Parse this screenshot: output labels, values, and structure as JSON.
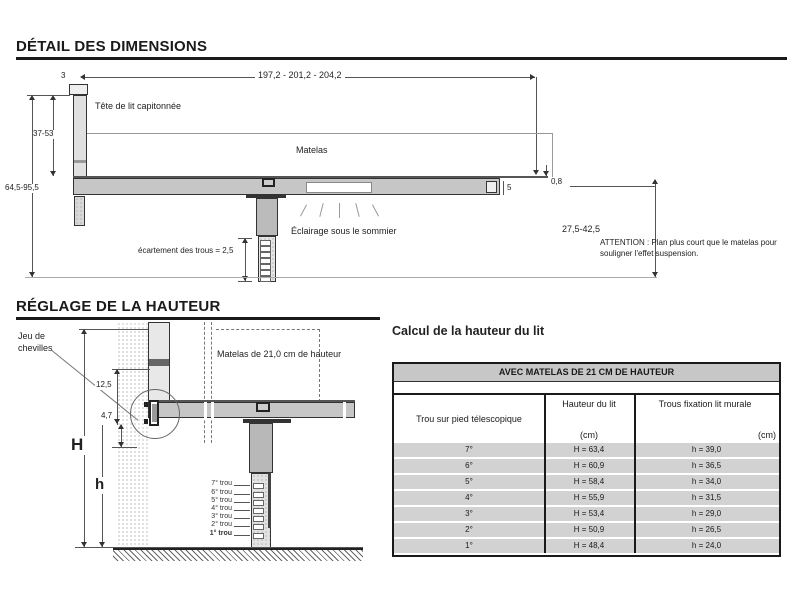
{
  "dim": {
    "title": "DÉTAIL DES DIMENSIONS",
    "length": "197,2 - 201,2 - 204,2",
    "cap_thickness": "3",
    "headboard": "Tête de lit capitonnée",
    "mattress": "Matelas",
    "headboard_height": "37-53",
    "overall_height": "64,5-95,5",
    "end_gap": "5",
    "plan_thickness": "0,8",
    "under_height": "27,5-42,5",
    "lighting": "Éclairage sous le sommier",
    "hole_spacing": "écartement des trous = 2,5",
    "attention": "ATTENTION : Plan plus court que le matelas pour souligner l'effet suspension."
  },
  "reglage": {
    "title": "RÉGLAGE DE LA HAUTEUR",
    "dowel_line1": "Jeu de",
    "dowel_line2": "chevilles",
    "mattress": "Matelas de 21,0 cm de hauteur",
    "dim_125": "12,5",
    "dim_47": "4,7",
    "big_h": "H",
    "small_h": "h",
    "holes": [
      "7° trou",
      "6° trou",
      "5° trou",
      "4° trou",
      "3° trou",
      "2° trou",
      "1° trou"
    ]
  },
  "table": {
    "title": "Calcul de la hauteur du lit",
    "band": "AVEC MATELAS DE 21 CM DE HAUTEUR",
    "col1": "Trou sur pied télescopique",
    "col2": "Hauteur du lit",
    "col2_unit": "(cm)",
    "col3": "Trous fixation lit murale",
    "col3_unit": "(cm)",
    "rows": [
      [
        "7°",
        "H = 63,4",
        "h = 39,0"
      ],
      [
        "6°",
        "H = 60,9",
        "h = 36,5"
      ],
      [
        "5°",
        "H = 58,4",
        "h = 34,0"
      ],
      [
        "4°",
        "H = 55,9",
        "h = 31,5"
      ],
      [
        "3°",
        "H = 53,4",
        "h = 29,0"
      ],
      [
        "2°",
        "H = 50,9",
        "h = 26,5"
      ],
      [
        "1°",
        "H = 48,4",
        "h = 24,0"
      ]
    ]
  },
  "colors": {
    "ink": "#1a1a1a",
    "line": "#555555",
    "platform": "#c6c6c6",
    "row": "#d2d2d2",
    "band": "#c7c7c7"
  }
}
